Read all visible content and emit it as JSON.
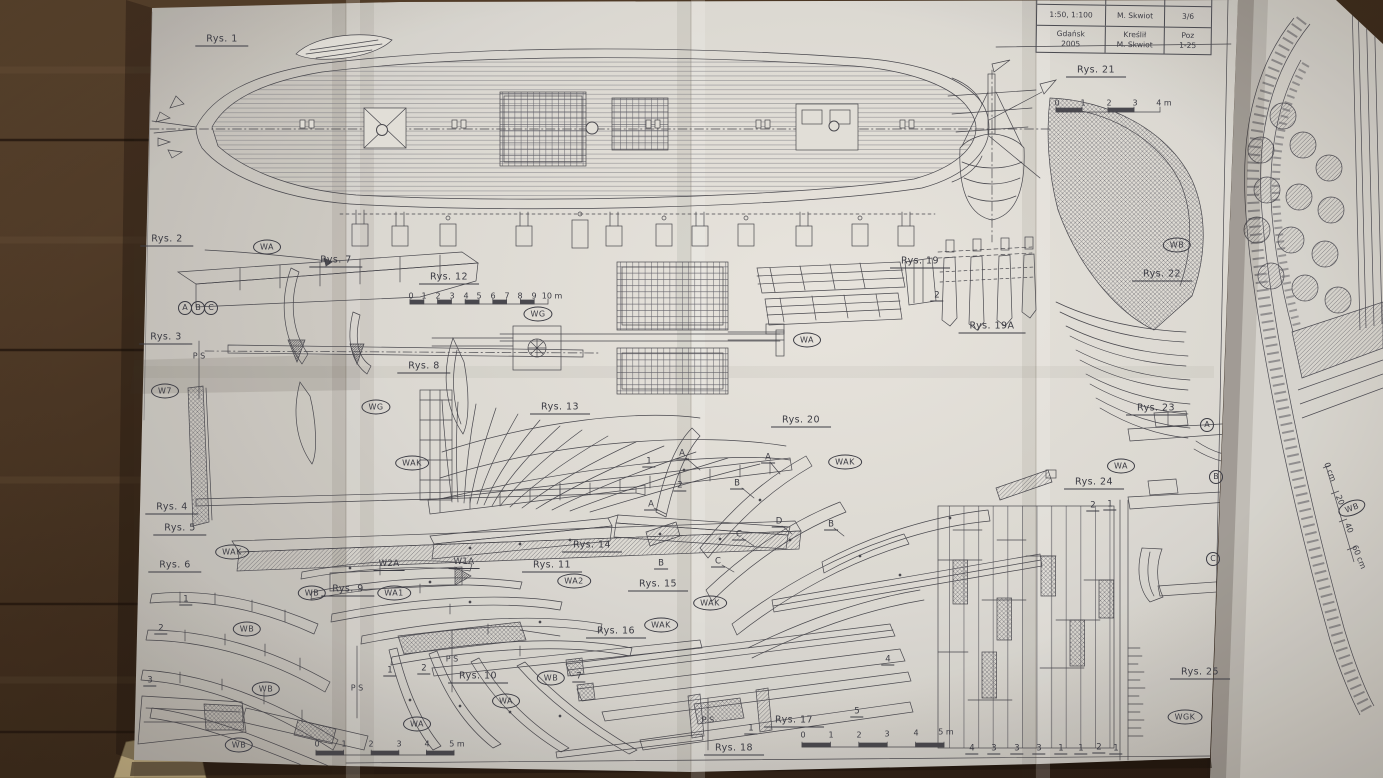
{
  "photo": {
    "paper_color": "#e3e1dc",
    "ink_color": "#45454c",
    "wood_color": "#3a281a",
    "kraft_paper_color": "#c9b485"
  },
  "title_block": {
    "h1": "Skala",
    "h2": "Opracował",
    "h3": "Arkusz",
    "r1c1": "1:50, 1:100",
    "r1c2": "M. Skwiot",
    "r1c3": "3/6",
    "r2c1a": "Gdańsk",
    "r2c1b": "2005",
    "r2c2a": "Kreślił",
    "r2c2b": "M. Skwiot",
    "r2c3a": "Poz",
    "r2c3b": "1-25"
  },
  "labels": [
    {
      "t": "Rys. 1",
      "x": 222,
      "y": 40,
      "k": "rys"
    },
    {
      "t": "Rys. 2",
      "x": 167,
      "y": 240,
      "k": "rys"
    },
    {
      "t": "Rys. 7",
      "x": 336,
      "y": 261,
      "k": "rys"
    },
    {
      "t": "Rys. 3",
      "x": 166,
      "y": 338,
      "k": "rys"
    },
    {
      "t": "Rys. 12",
      "x": 449,
      "y": 278,
      "k": "rys"
    },
    {
      "t": "Rys. 8",
      "x": 424,
      "y": 367,
      "k": "rys"
    },
    {
      "t": "Rys. 13",
      "x": 560,
      "y": 408,
      "k": "rys"
    },
    {
      "t": "Rys. 4",
      "x": 172,
      "y": 508,
      "k": "rys"
    },
    {
      "t": "Rys. 5",
      "x": 180,
      "y": 529,
      "k": "rys"
    },
    {
      "t": "Rys. 6",
      "x": 175,
      "y": 566,
      "k": "rys"
    },
    {
      "t": "Rys. 9",
      "x": 348,
      "y": 590,
      "k": "rys"
    },
    {
      "t": "Rys. 11",
      "x": 552,
      "y": 566,
      "k": "rys"
    },
    {
      "t": "Rys. 14",
      "x": 592,
      "y": 546,
      "k": "rys"
    },
    {
      "t": "Rys. 15",
      "x": 658,
      "y": 585,
      "k": "rys"
    },
    {
      "t": "Rys. 16",
      "x": 616,
      "y": 632,
      "k": "rys"
    },
    {
      "t": "Rys. 10",
      "x": 478,
      "y": 677,
      "k": "rys"
    },
    {
      "t": "Rys. 17",
      "x": 794,
      "y": 721,
      "k": "rys"
    },
    {
      "t": "Rys. 18",
      "x": 734,
      "y": 749,
      "k": "rys"
    },
    {
      "t": "Rys. 20",
      "x": 801,
      "y": 421,
      "k": "rys"
    },
    {
      "t": "Rys. 19",
      "x": 920,
      "y": 262,
      "k": "rys"
    },
    {
      "t": "Rys. 19A",
      "x": 992,
      "y": 327,
      "k": "rys"
    },
    {
      "t": "Rys. 21",
      "x": 1096,
      "y": 71,
      "k": "rys"
    },
    {
      "t": "Rys. 22",
      "x": 1162,
      "y": 275,
      "k": "rys"
    },
    {
      "t": "Rys. 23",
      "x": 1156,
      "y": 409,
      "k": "rys"
    },
    {
      "t": "Rys. 24",
      "x": 1094,
      "y": 483,
      "k": "rys"
    },
    {
      "t": "Rys. 25",
      "x": 1200,
      "y": 673,
      "k": "rys"
    },
    {
      "t": "WA",
      "x": 267,
      "y": 247,
      "k": "ov"
    },
    {
      "t": "WG",
      "x": 538,
      "y": 314,
      "k": "ov"
    },
    {
      "t": "WG",
      "x": 376,
      "y": 407,
      "k": "ov"
    },
    {
      "t": "W7",
      "x": 165,
      "y": 391,
      "k": "ov"
    },
    {
      "t": "WAK",
      "x": 232,
      "y": 552,
      "k": "ov"
    },
    {
      "t": "WAK",
      "x": 412,
      "y": 463,
      "k": "ov"
    },
    {
      "t": "WB",
      "x": 312,
      "y": 593,
      "k": "ov"
    },
    {
      "t": "WA1",
      "x": 394,
      "y": 593,
      "k": "ov"
    },
    {
      "t": "WA2",
      "x": 574,
      "y": 581,
      "k": "ov"
    },
    {
      "t": "WAK",
      "x": 661,
      "y": 625,
      "k": "ov"
    },
    {
      "t": "WAK",
      "x": 710,
      "y": 603,
      "k": "ov"
    },
    {
      "t": "WAK",
      "x": 845,
      "y": 462,
      "k": "ov"
    },
    {
      "t": "WA",
      "x": 807,
      "y": 340,
      "k": "ov"
    },
    {
      "t": "WA",
      "x": 417,
      "y": 724,
      "k": "ov"
    },
    {
      "t": "WA",
      "x": 506,
      "y": 701,
      "k": "ov"
    },
    {
      "t": "WB",
      "x": 551,
      "y": 678,
      "k": "ov"
    },
    {
      "t": "WB",
      "x": 247,
      "y": 629,
      "k": "ov"
    },
    {
      "t": "WB",
      "x": 266,
      "y": 689,
      "k": "ov"
    },
    {
      "t": "WB",
      "x": 239,
      "y": 745,
      "k": "ov"
    },
    {
      "t": "WB",
      "x": 1177,
      "y": 245,
      "k": "ov"
    },
    {
      "t": "WA",
      "x": 1121,
      "y": 466,
      "k": "ov"
    },
    {
      "t": "WGK",
      "x": 1185,
      "y": 717,
      "k": "ov"
    },
    {
      "t": "WB",
      "x": 1352,
      "y": 508,
      "k": "ov",
      "r": -20
    },
    {
      "t": "A",
      "x": 185,
      "y": 308,
      "k": "ci"
    },
    {
      "t": "B",
      "x": 198,
      "y": 308,
      "k": "ci"
    },
    {
      "t": "C",
      "x": 211,
      "y": 308,
      "k": "ci"
    },
    {
      "t": "A",
      "x": 1207,
      "y": 425,
      "k": "ci"
    },
    {
      "t": "B",
      "x": 1216,
      "y": 477,
      "k": "ci"
    },
    {
      "t": "C",
      "x": 1213,
      "y": 559,
      "k": "ci"
    },
    {
      "t": "W2A",
      "x": 389,
      "y": 565,
      "k": "co"
    },
    {
      "t": "W1A",
      "x": 464,
      "y": 563,
      "k": "co"
    },
    {
      "t": "B",
      "x": 661,
      "y": 564,
      "k": "le"
    },
    {
      "t": "A",
      "x": 682,
      "y": 454,
      "k": "le"
    },
    {
      "t": "A",
      "x": 768,
      "y": 458,
      "k": "le"
    },
    {
      "t": "A",
      "x": 651,
      "y": 505,
      "k": "le"
    },
    {
      "t": "B",
      "x": 737,
      "y": 484,
      "k": "le"
    },
    {
      "t": "B",
      "x": 831,
      "y": 525,
      "k": "le"
    },
    {
      "t": "C",
      "x": 739,
      "y": 535,
      "k": "le"
    },
    {
      "t": "C",
      "x": 718,
      "y": 562,
      "k": "le"
    },
    {
      "t": "D",
      "x": 779,
      "y": 522,
      "k": "le"
    },
    {
      "t": "1",
      "x": 649,
      "y": 462,
      "k": "le"
    },
    {
      "t": "2",
      "x": 680,
      "y": 486,
      "k": "le"
    },
    {
      "t": "1",
      "x": 390,
      "y": 671,
      "k": "le"
    },
    {
      "t": "2",
      "x": 424,
      "y": 669,
      "k": "le"
    },
    {
      "t": "1",
      "x": 186,
      "y": 600,
      "k": "le"
    },
    {
      "t": "2",
      "x": 161,
      "y": 629,
      "k": "le"
    },
    {
      "t": "3",
      "x": 150,
      "y": 681,
      "k": "le"
    },
    {
      "t": "1",
      "x": 751,
      "y": 729,
      "k": "le"
    },
    {
      "t": "5",
      "x": 857,
      "y": 712,
      "k": "le"
    },
    {
      "t": "4",
      "x": 888,
      "y": 660,
      "k": "le"
    },
    {
      "t": "7",
      "x": 579,
      "y": 677,
      "k": "le"
    },
    {
      "t": "2",
      "x": 937,
      "y": 296,
      "k": "le"
    },
    {
      "t": "2",
      "x": 1093,
      "y": 506,
      "k": "le"
    },
    {
      "t": "1",
      "x": 1110,
      "y": 505,
      "k": "le"
    },
    {
      "t": "4",
      "x": 972,
      "y": 749,
      "k": "le"
    },
    {
      "t": "3",
      "x": 994,
      "y": 749,
      "k": "le"
    },
    {
      "t": "3",
      "x": 1017,
      "y": 749,
      "k": "le"
    },
    {
      "t": "3",
      "x": 1039,
      "y": 749,
      "k": "le"
    },
    {
      "t": "1",
      "x": 1061,
      "y": 749,
      "k": "le"
    },
    {
      "t": "1",
      "x": 1081,
      "y": 749,
      "k": "le"
    },
    {
      "t": "2",
      "x": 1099,
      "y": 748,
      "k": "le"
    },
    {
      "t": "1",
      "x": 1116,
      "y": 749,
      "k": "le"
    },
    {
      "t": "P S",
      "x": 199,
      "y": 356,
      "k": "nu"
    },
    {
      "t": "P S",
      "x": 357,
      "y": 688,
      "k": "nu"
    },
    {
      "t": "P S",
      "x": 452,
      "y": 659,
      "k": "nu"
    },
    {
      "t": "P S",
      "x": 708,
      "y": 720,
      "k": "nu"
    },
    {
      "t": "0",
      "x": 411,
      "y": 296,
      "k": "nu"
    },
    {
      "t": "1",
      "x": 424,
      "y": 296,
      "k": "nu"
    },
    {
      "t": "2",
      "x": 438,
      "y": 296,
      "k": "nu"
    },
    {
      "t": "3",
      "x": 452,
      "y": 296,
      "k": "nu"
    },
    {
      "t": "4",
      "x": 466,
      "y": 296,
      "k": "nu"
    },
    {
      "t": "5",
      "x": 479,
      "y": 296,
      "k": "nu"
    },
    {
      "t": "6",
      "x": 493,
      "y": 296,
      "k": "nu"
    },
    {
      "t": "7",
      "x": 507,
      "y": 296,
      "k": "nu"
    },
    {
      "t": "8",
      "x": 520,
      "y": 296,
      "k": "nu"
    },
    {
      "t": "9",
      "x": 534,
      "y": 296,
      "k": "nu"
    },
    {
      "t": "10 m",
      "x": 552,
      "y": 296,
      "k": "nu"
    },
    {
      "t": "0",
      "x": 1057,
      "y": 103,
      "k": "nu"
    },
    {
      "t": "1",
      "x": 1083,
      "y": 103,
      "k": "nu"
    },
    {
      "t": "2",
      "x": 1109,
      "y": 103,
      "k": "nu"
    },
    {
      "t": "3",
      "x": 1135,
      "y": 103,
      "k": "nu"
    },
    {
      "t": "4 m",
      "x": 1164,
      "y": 103,
      "k": "nu"
    },
    {
      "t": "0",
      "x": 317,
      "y": 744,
      "k": "nu"
    },
    {
      "t": "1",
      "x": 344,
      "y": 744,
      "k": "nu"
    },
    {
      "t": "2",
      "x": 371,
      "y": 744,
      "k": "nu"
    },
    {
      "t": "3",
      "x": 399,
      "y": 744,
      "k": "nu"
    },
    {
      "t": "4",
      "x": 427,
      "y": 744,
      "k": "nu"
    },
    {
      "t": "5 m",
      "x": 457,
      "y": 744,
      "k": "nu"
    },
    {
      "t": "0",
      "x": 803,
      "y": 735,
      "k": "nu"
    },
    {
      "t": "1",
      "x": 831,
      "y": 735,
      "k": "nu"
    },
    {
      "t": "2",
      "x": 859,
      "y": 735,
      "k": "nu"
    },
    {
      "t": "3",
      "x": 887,
      "y": 734,
      "k": "nu"
    },
    {
      "t": "4",
      "x": 916,
      "y": 733,
      "k": "nu"
    },
    {
      "t": "5 m",
      "x": 946,
      "y": 732,
      "k": "nu"
    },
    {
      "t": "0 cm",
      "x": 1330,
      "y": 472,
      "k": "nu",
      "r": 68
    },
    {
      "t": "20",
      "x": 1340,
      "y": 500,
      "k": "nu",
      "r": 68
    },
    {
      "t": "40",
      "x": 1349,
      "y": 528,
      "k": "nu",
      "r": 68
    },
    {
      "t": "60 cm",
      "x": 1359,
      "y": 557,
      "k": "nu",
      "r": 68
    }
  ]
}
